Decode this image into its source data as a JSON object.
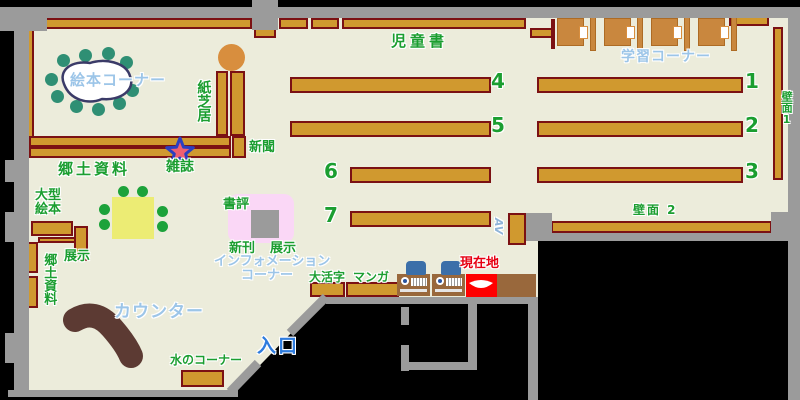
{
  "labels": {
    "picture_book_corner": "絵本コーナー",
    "kamishibai": "紙芝居",
    "newspaper": "新聞",
    "magazine": "雑誌",
    "local_materials_upper": "郷土資料",
    "large_picture_books": "大型絵本",
    "display_upper": "展示",
    "local_materials_lower": "郷土資料",
    "counter": "カウンター",
    "water_corner": "水のコーナー",
    "entrance": "入口",
    "children_books": "児童書",
    "study_corner": "学習コーナー",
    "wall_1": "壁面1",
    "wall_2": "壁面 2",
    "book_review": "書評",
    "new_arrivals": "新刊",
    "display_lower": "展示",
    "information_line1": "インフォメーション",
    "information_line2": "コーナー",
    "large_print": "大活字",
    "manga": "マンガ",
    "current_location": "現在地",
    "av": "AV"
  },
  "shelf_numbers": [
    "1",
    "2",
    "3",
    "4",
    "5",
    "6",
    "7"
  ],
  "colors": {
    "floor": "#ECECDB",
    "wall": "#9B9B9B",
    "shelf": "#D0992F",
    "shelf_border": "#7B1113",
    "label_green": "#1B9E30",
    "label_blue": "#9CC5E8",
    "entrance_blue": "#2E7CDE",
    "current_location_red": "#FF0000",
    "pink_display": "#FAD7F6",
    "table_yellow": "#ECEC74",
    "chair_teal": "#2F8F74",
    "chair_green": "#1CA23A",
    "counter_brown": "#5C3A33",
    "star_fill": "#EE6070",
    "star_outline": "#2B3FC0"
  }
}
